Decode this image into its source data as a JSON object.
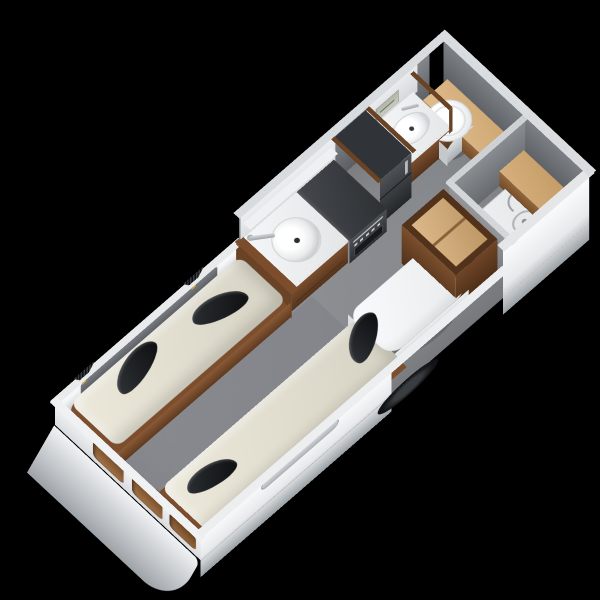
{
  "scene": {
    "background": "#000000",
    "subject": "3D isometric cutaway floor plan of a caravan interior",
    "view": "oblique top-down, caravan long axis running from lower-left (front) to upper-right (rear)"
  },
  "colors": {
    "background": "#000000",
    "shell": "#f2f3f5",
    "shellShade": "#b4b8bc",
    "wallGray": "#7b7e82",
    "wallGrayDark": "#5a5d61",
    "wallTop": "#dfe2e4",
    "floor": "#8b8e92",
    "mattress": "#e6e3d5",
    "cushion": "#17191c",
    "wood": "#7c4e2e",
    "woodDark": "#53321b",
    "woodLight": "#d8b384",
    "appliance": "#33363a",
    "steel": "#c2c6c9",
    "white": "#f4f5f6",
    "accentGold": "#c9a23f"
  },
  "parts": [
    "caravan-shell",
    "front-skirt",
    "front-windows",
    "side-window",
    "window-slot",
    "wheel",
    "interior-floor",
    "bed-left",
    "bed-right",
    "bolster-cushions",
    "wall-fan-lamps",
    "kitchen-counter",
    "kitchen-sink",
    "kitchen-faucet",
    "cooker-hob",
    "oven",
    "fridge",
    "overhead-shelf",
    "bathroom-vanity",
    "bathroom-sink",
    "bathroom-faucet",
    "wall-heater",
    "toilet",
    "rear-bench",
    "shower-tray",
    "shower-drain",
    "shower-hose",
    "wardrobe",
    "dinette-table",
    "floor-cables",
    "partition-walls"
  ]
}
